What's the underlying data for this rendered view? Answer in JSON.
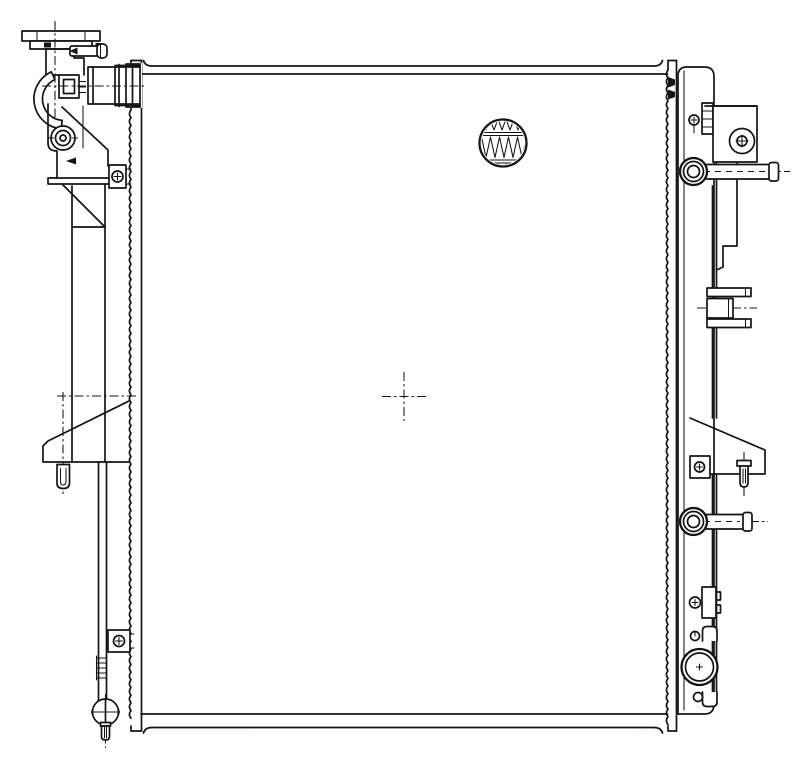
{
  "meta": {
    "title": "Radiator assembly - technical parts line drawing, front elevation",
    "drawing_style": "black line art on white, no text labels"
  },
  "palette": {
    "background": "#ffffff",
    "line": "#141414"
  },
  "components": {
    "core": {
      "title": "Radiator core (large rectangular panel)"
    },
    "fin_detail": {
      "title": "Circular inset showing corrugated fin pattern of core"
    },
    "center_mark": {
      "title": "Center crosshair reference mark"
    },
    "left_side_plate": {
      "title": "Left serrated side plate"
    },
    "right_side_plate": {
      "title": "Right serrated side plate"
    },
    "filler_flange": {
      "title": "Filler neck top flange"
    },
    "filler_neck": {
      "title": "Filler neck body"
    },
    "overflow_tube": {
      "title": "Overflow tube with cap"
    },
    "inlet_hose": {
      "title": "Curved inlet hose elbow"
    },
    "neck_boss": {
      "title": "Filler neck square boss"
    },
    "inlet_pipe": {
      "title": "Upper inlet pipe joint"
    },
    "left_tank": {
      "title": "Left header tank with circular boss"
    },
    "upper_left_bracket": {
      "title": "Upper left mounting bracket with bolt"
    },
    "left_triangle_bracket": {
      "title": "Left triangular mounting foot"
    },
    "left_mount_pin": {
      "title": "Left lower mounting pin"
    },
    "left_channel": {
      "title": "Left lower channel with ribs"
    },
    "lower_left_bracket": {
      "title": "Lower left bracket with bolt"
    },
    "drain_cock": {
      "title": "Drain cock with wing handle and stem"
    },
    "right_tank": {
      "title": "Right header tank"
    },
    "upper_right_bracket": {
      "title": "Upper right mounting bracket with bolt boss"
    },
    "upper_mount_stud": {
      "title": "Upper right mounting stud with grommet"
    },
    "support_rail": {
      "title": "Right vertical support rail"
    },
    "pipe_clamp": {
      "title": "Right side pipe clamp block"
    },
    "right_triangle_bracket": {
      "title": "Right triangular mounting foot with bolt block and pin"
    },
    "lower_mount_stud": {
      "title": "Lower right mounting stud with grommet"
    },
    "lower_right_bracket": {
      "title": "Lower right bracket with bolt"
    },
    "outlet_pipe": {
      "title": "Outlet pipe opening (end view) with retaining hooks"
    }
  }
}
